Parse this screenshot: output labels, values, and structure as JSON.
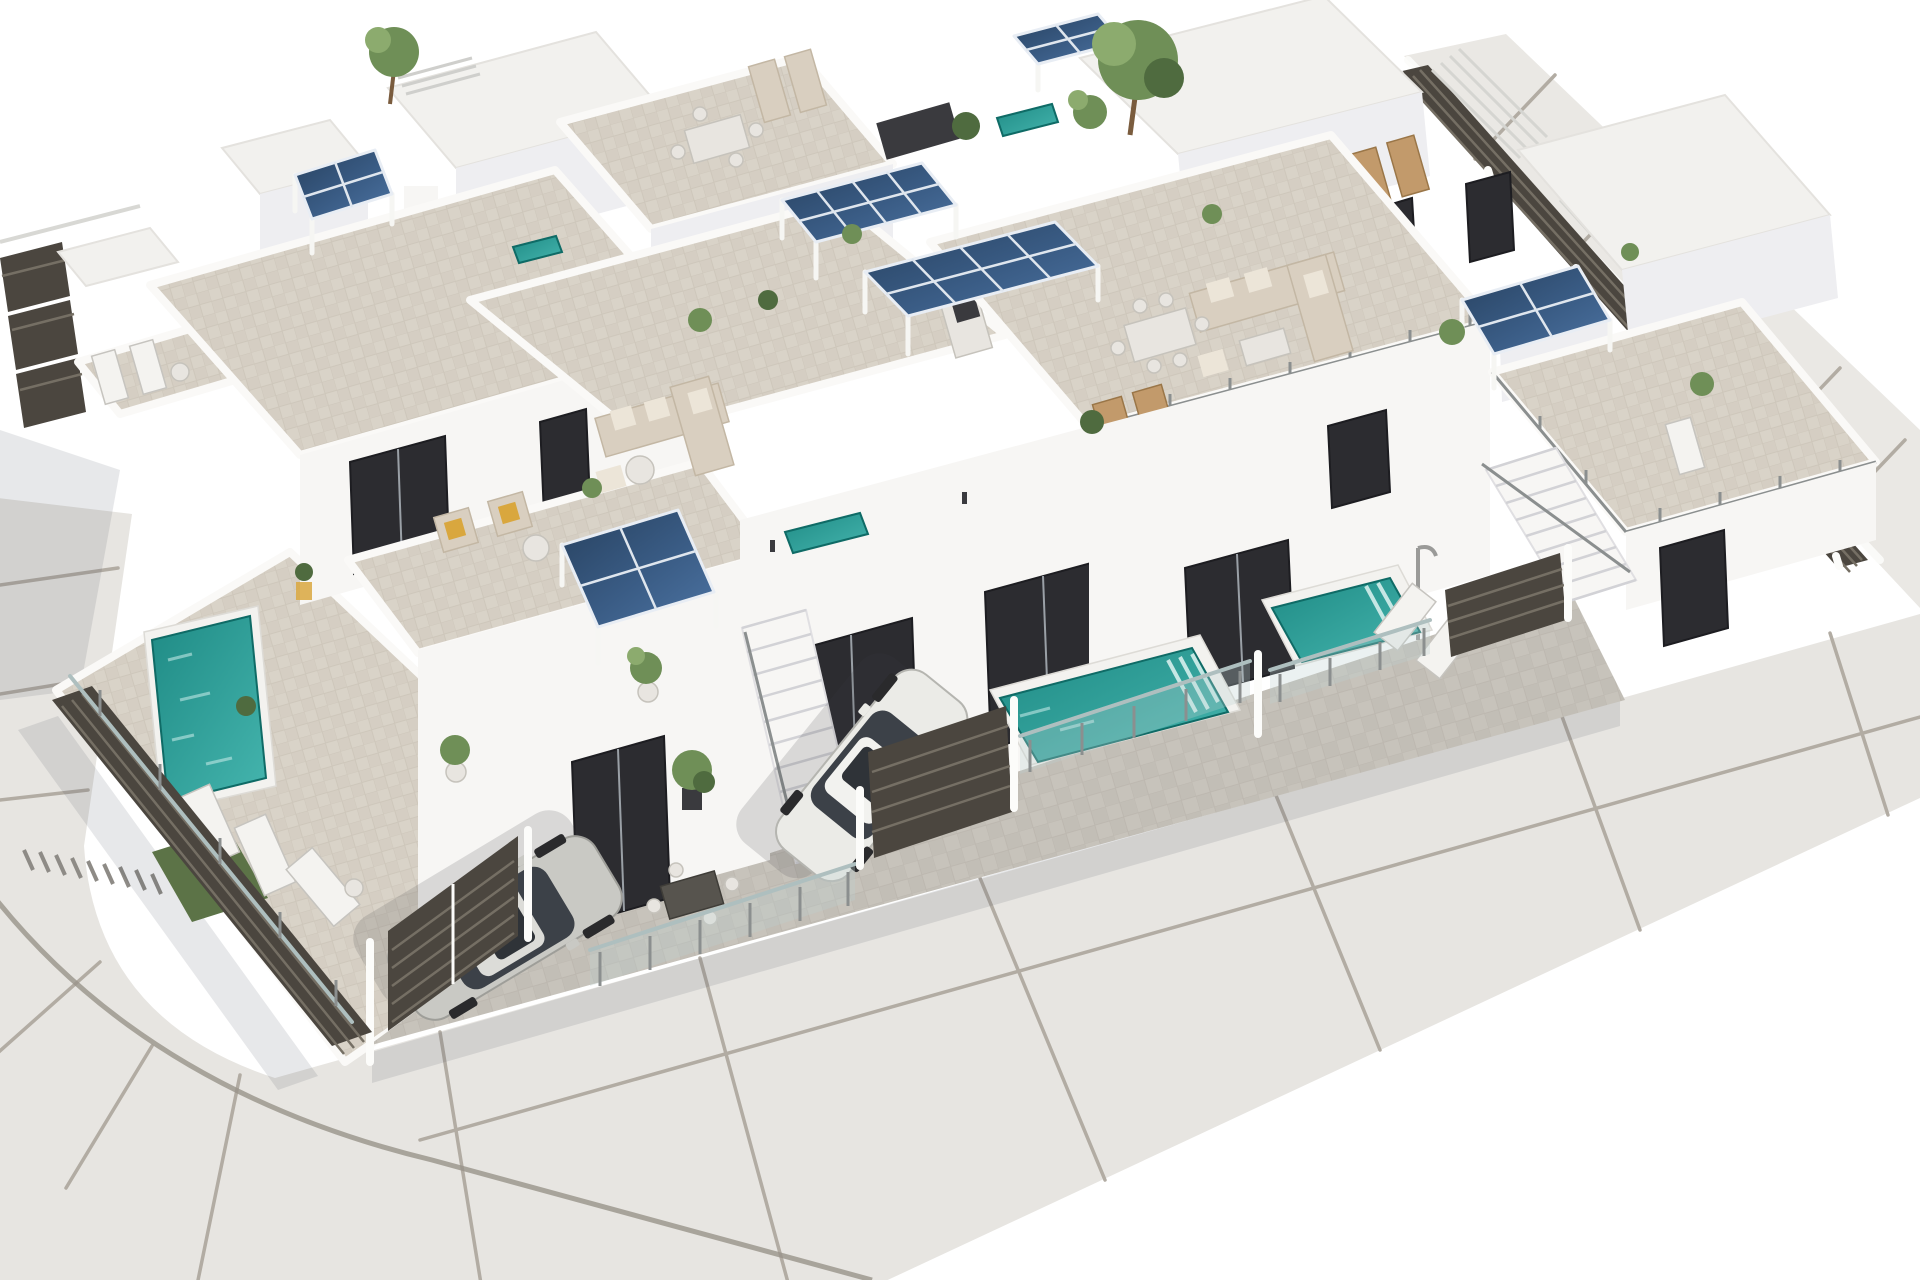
{
  "scene": {
    "type": "architectural-3d-render",
    "title": "Aerial 3D render of a modern white villa development with rooftop terraces, photovoltaic pergolas, private pools, driveways with parked cars and a curved street wrapping the corner plot",
    "view": "aerial isometric, street corner at lower left, white background",
    "background": "#ffffff"
  },
  "palette": {
    "bg": "#ffffff",
    "wall": "#f7f6f4",
    "wallface": "#eeeef1",
    "wallshade": "#e2e2e7",
    "whiteroof": "#f2f1ee",
    "tile": "#d9d3c8",
    "tiledark": "#cdc6b9",
    "tileline": "#c6bfb2",
    "drv": "#c7c3bb",
    "drvline": "#b8b3a9",
    "road": "#e7e5e1",
    "sidewalk": "#eae8e4",
    "roadseam": "#b2aca3",
    "curb": "#99938a",
    "solardk": "#27415f",
    "solarmd": "#3a5c85",
    "solarlt": "#4d74a3",
    "solargrid": "#dfe6ee",
    "pooldeep": "#1f8b85",
    "poollight": "#45b5ae",
    "pooledge": "#0f6b66",
    "fence": "#4b463f",
    "fenceslat": "#756f64",
    "glassrail": "#aebfbf",
    "metal": "#8b8f8f",
    "carsilver": "#c9c9c4",
    "carwhite": "#ebebe7",
    "carglass": "#3c4148",
    "green": "#6f8f57",
    "greendk": "#4f6b3f",
    "greenlt": "#8cab6e",
    "lawn": "#5c7347",
    "wood": "#c29a6b",
    "wooddk": "#9a7648",
    "sofa": "#d9cfc0",
    "charcoal": "#2c2c30",
    "shadow": "rgba(70,76,92,0.13)",
    "yellow": "#d9a73e",
    "red": "#b8422f"
  },
  "counts": {
    "residential_units_visible": 6,
    "solar_pergolas": 6,
    "swimming_pools": 3,
    "small_pools": 3,
    "cars": 2,
    "entrance_gates": 2,
    "external_staircases": 2,
    "roof_terraces": 5
  },
  "features": [
    {
      "id": "street-pavement",
      "label": "Curved street pavement with expansion joints wrapping the corner plot"
    },
    {
      "id": "right-sidewalk",
      "label": "Sidewalk strip along the upper-right boundary"
    },
    {
      "id": "villa-cluster",
      "label": "Cluster of white modern villas with flat roofs"
    },
    {
      "id": "roof-terraces",
      "label": "Tiled rooftop terraces with outdoor furniture"
    },
    {
      "id": "solar-pergolas",
      "label": "Photovoltaic solar-panel pergolas on the roofs"
    },
    {
      "id": "left-pool",
      "label": "Private swimming pool in the left garden"
    },
    {
      "id": "plunge-pools",
      "label": "Plunge pools with glass balustrades in front of the villas"
    },
    {
      "id": "silver-car",
      "label": "Silver car parked in the left driveway"
    },
    {
      "id": "white-car",
      "label": "White car parked in the center driveway"
    },
    {
      "id": "entrance-gates",
      "label": "Dark slatted entrance gates"
    },
    {
      "id": "perimeter-fence",
      "label": "Dark slatted perimeter fencing"
    },
    {
      "id": "external-stairs",
      "label": "External staircases to the roof terraces"
    },
    {
      "id": "landscaping",
      "label": "Potted plants and small trees"
    },
    {
      "id": "outdoor-furniture",
      "label": "Outdoor lounge and dining furniture"
    },
    {
      "id": "lawn-patch",
      "label": "Artificial lawn patch beside the pool"
    },
    {
      "id": "outdoor-kitchen",
      "label": "Rooftop outdoor kitchen with barbecue"
    },
    {
      "id": "sun-loungers",
      "label": "Sun loungers beside the pools"
    },
    {
      "id": "glass-balustrades",
      "label": "Glass and steel balustrades along the street front"
    }
  ]
}
